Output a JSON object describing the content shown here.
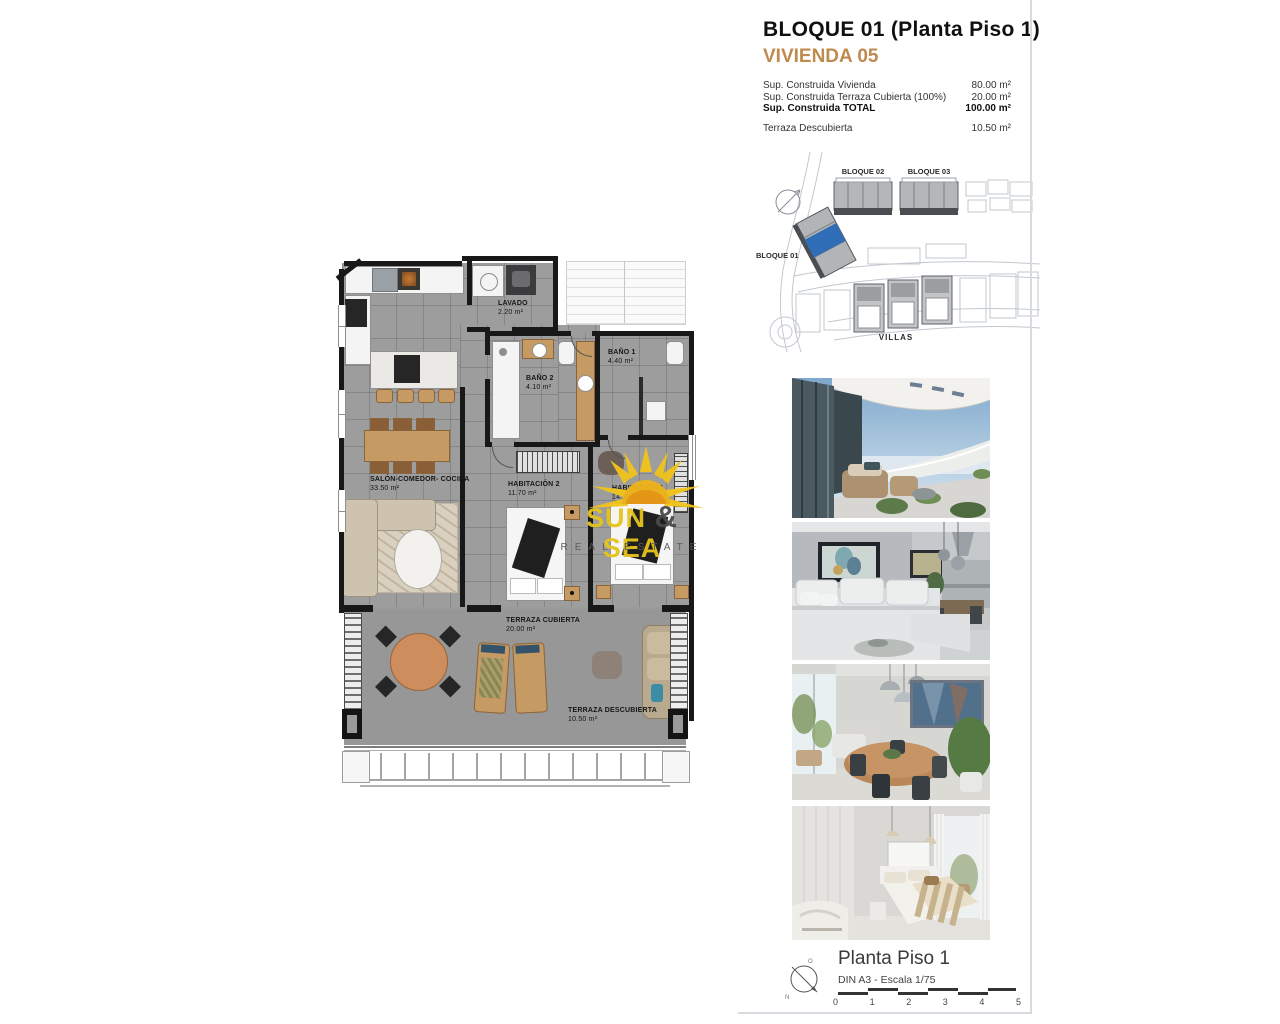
{
  "header": {
    "title": "BLOQUE 01  (Planta Piso 1)",
    "unit": "VIVIENDA 05",
    "unit_color": "#bf8a4d",
    "rows": [
      {
        "label": "Sup. Construida Vivienda",
        "value": "80.00 m²"
      },
      {
        "label": "Sup. Construida Terraza Cubierta (100%)",
        "value": "20.00 m²"
      },
      {
        "label": "Sup. Construida TOTAL",
        "value": "100.00 m²"
      },
      {
        "label": "Terraza Descubierta",
        "value": "10.50 m²"
      }
    ]
  },
  "site_plan": {
    "bloque01": "BLOQUE 01",
    "bloque02": "BLOQUE 02",
    "bloque03": "BLOQUE 03",
    "villas": "VILLAS",
    "highlight_color": "#2f6db6"
  },
  "floor_plan": {
    "rooms": [
      {
        "name": "LAVADO",
        "area": "2.20 m²"
      },
      {
        "name": "BAÑO 2",
        "area": "4.10 m²"
      },
      {
        "name": "BAÑO 1",
        "area": "4.40 m²"
      },
      {
        "name": "HABITACIÓN 1",
        "area": "14.90 m²"
      },
      {
        "name": "HABITACIÓN 2",
        "area": "11.70 m²"
      },
      {
        "name": "SALÓN-COMEDOR- COCINA",
        "area": "33.50 m²"
      },
      {
        "name": "TERRAZA CUBIERTA",
        "area": "20.00 m²"
      },
      {
        "name": "TERRAZA DESCUBIERTA",
        "area": "10.50 m²"
      }
    ]
  },
  "watermark": {
    "word1": "SUN",
    "amp": "&",
    "word2": "SEA",
    "tagline": "REAL ESTATE",
    "color": "#e6c31c"
  },
  "photos": [
    {
      "name": "terrace-exterior-photo"
    },
    {
      "name": "living-room-photo"
    },
    {
      "name": "dining-room-photo"
    },
    {
      "name": "bedroom-photo"
    }
  ],
  "footer": {
    "title": "Planta Piso 1",
    "scale": "DIN A3 - Escala 1/75",
    "ticks": [
      "0",
      "1",
      "2",
      "3",
      "4",
      "5"
    ]
  }
}
